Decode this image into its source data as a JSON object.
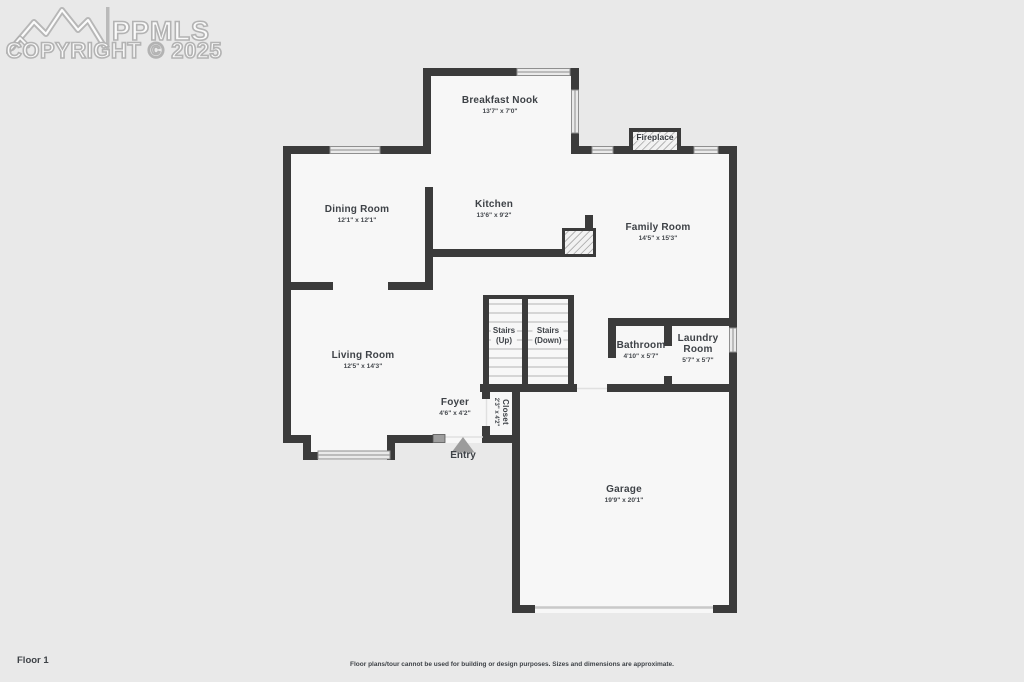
{
  "watermark": {
    "brand": "PPMLS",
    "copyright": "COPYRIGHT © 2025",
    "logo_icon": "mountain-logo"
  },
  "rooms": {
    "breakfast_nook": {
      "name": "Breakfast Nook",
      "dims": "13'7\" x 7'0\""
    },
    "kitchen": {
      "name": "Kitchen",
      "dims": "13'6\" x 9'2\""
    },
    "dining_room": {
      "name": "Dining Room",
      "dims": "12'1\" x 12'1\""
    },
    "family_room": {
      "name": "Family Room",
      "dims": "14'5\" x 15'3\""
    },
    "living_room": {
      "name": "Living Room",
      "dims": "12'5\" x 14'3\""
    },
    "stairs_up": {
      "name": "Stairs",
      "sub": "(Up)"
    },
    "stairs_down": {
      "name": "Stairs",
      "sub": "(Down)"
    },
    "bathroom": {
      "name": "Bathroom",
      "dims": "4'10\" x 5'7\""
    },
    "laundry_room": {
      "name": "Laundry Room",
      "dims": "5'7\" x 5'7\""
    },
    "foyer": {
      "name": "Foyer",
      "dims": "4'6\" x 4'2\""
    },
    "closet": {
      "name": "Closet",
      "dims": "2'3\" x 4'2\""
    },
    "garage": {
      "name": "Garage",
      "dims": "19'9\" x 20'1\""
    }
  },
  "features": {
    "fireplace_label": "Fireplace",
    "entry_label": "Entry"
  },
  "footer": {
    "floor_label": "Floor 1",
    "disclaimer": "Floor plans/tour cannot be used for building or design purposes. Sizes and dimensions are approximate."
  },
  "colors": {
    "wall": "#3b3b3b",
    "floor": "#f7f7f7",
    "page_background": "#e9e9e9",
    "label_text": "#3e4247",
    "stair_tread": "#d5d5d5",
    "watermark": "#b3b3b3",
    "entry_arrow": "#9c9c9c",
    "garage_door": "#c9c9c9"
  }
}
